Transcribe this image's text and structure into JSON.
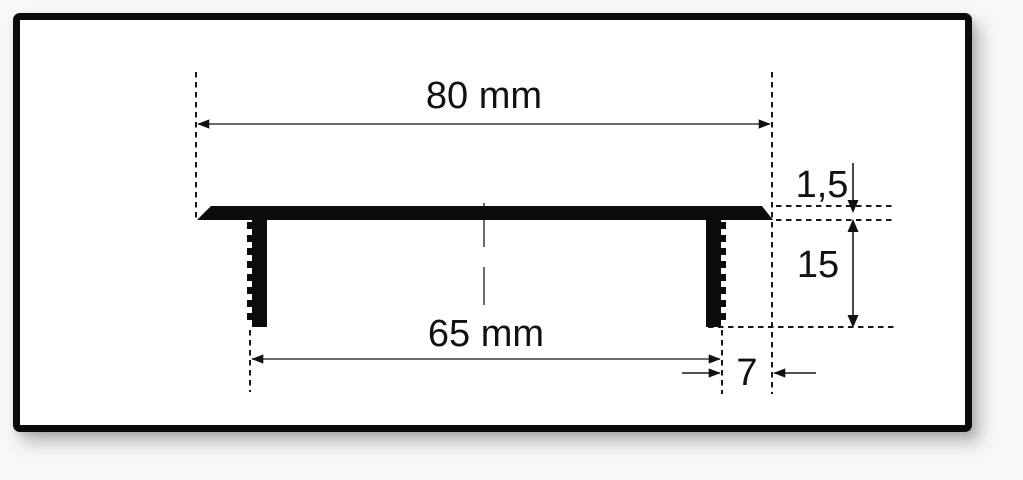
{
  "figure": {
    "kind": "dimensioned cross-section drawing",
    "dimensions": {
      "total_width": {
        "label": "80 mm",
        "value": 80,
        "unit": "mm"
      },
      "inner_width": {
        "label": "65 mm",
        "value": 65,
        "unit": "mm"
      },
      "plate_thickness": {
        "label": "1,5",
        "value": 1.5,
        "unit": "mm"
      },
      "leg_height": {
        "label": "15",
        "value": 15,
        "unit": "mm"
      },
      "edge_offset": {
        "label": "7",
        "value": 7,
        "unit": "mm"
      }
    },
    "colors": {
      "ink": "#0b0b0b",
      "canvas": "#ffffff",
      "frame_border": "#0b0b0b",
      "page_background": "#f7f8f8"
    }
  }
}
